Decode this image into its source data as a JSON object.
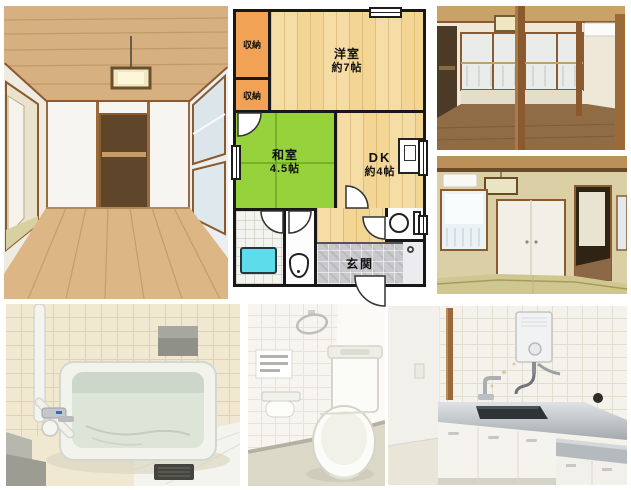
{
  "floorplan": {
    "closet_top_label": "収納",
    "closet_bottom_label": "収納",
    "western_room": {
      "name": "洋室",
      "size": "約7帖"
    },
    "japanese_room": {
      "name": "和室",
      "size": "4.5帖"
    },
    "dining_kitchen": {
      "name": "DK",
      "size": "約4帖"
    },
    "entrance_label": "玄関",
    "colors": {
      "wall": "#181818",
      "closet_orange": "#f1a254",
      "wood_floor": "#f3d694",
      "tatami_green": "#96d23c",
      "bathtub_cyan": "#5ddcec",
      "entrance_tile_gray": "#c8c8cd"
    }
  },
  "photos": {
    "living_room": "wood-floor-room-with-closet-and-pendant-light",
    "upper_room": "room-through-wood-pillars-with-windows",
    "tatami_room": "tatami-room-with-fusuma-closet",
    "bathroom": "bathroom-with-bathtub-and-shower",
    "toilet": "toilet-room",
    "kitchen": "kitchen-with-sink-and-water-heater"
  }
}
